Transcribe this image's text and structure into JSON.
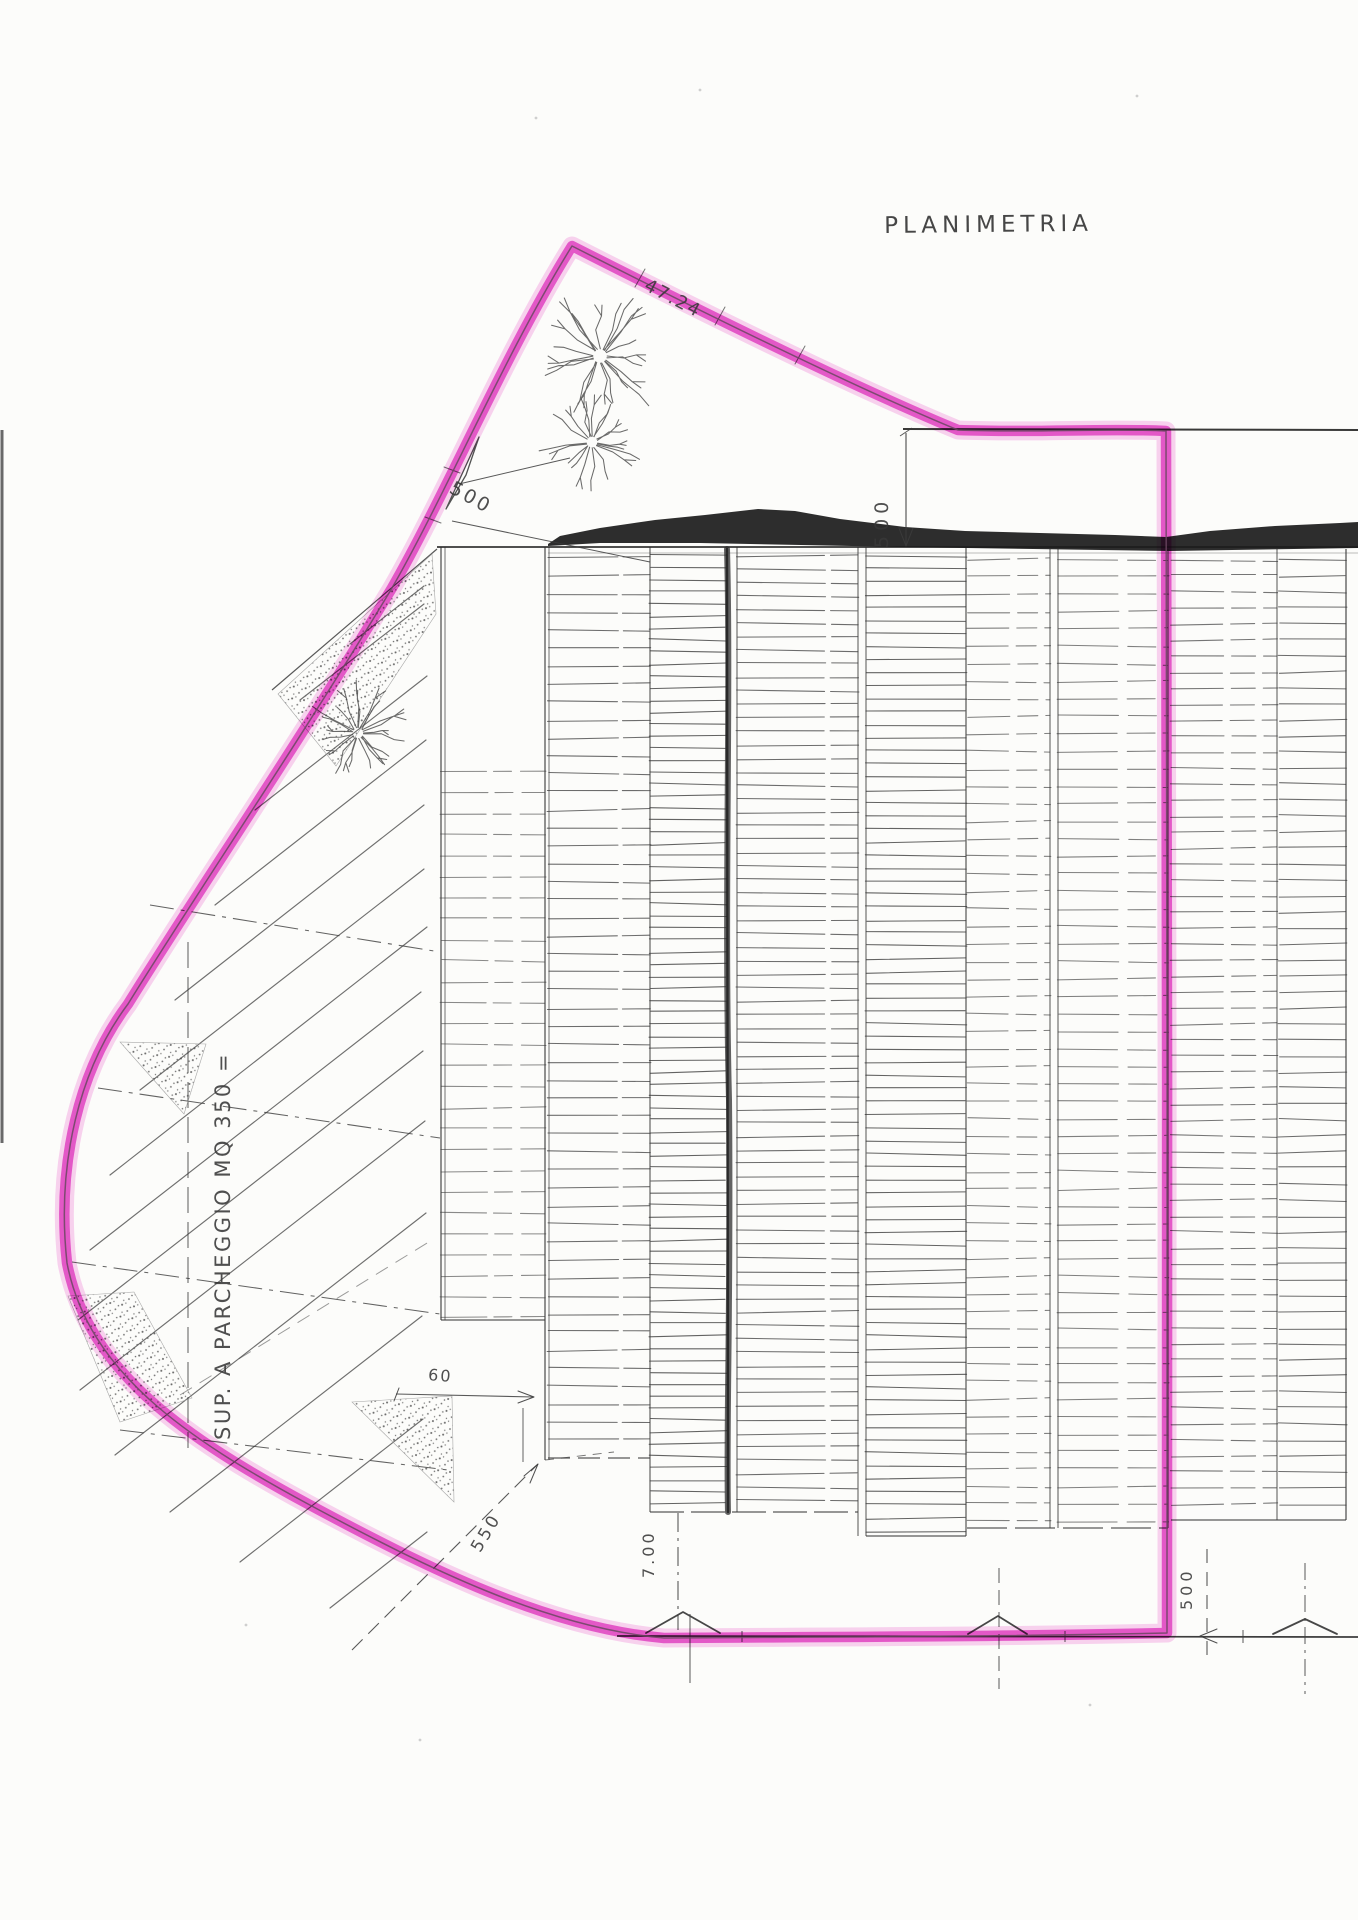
{
  "drawing": {
    "title": "PLANIMETRIA"
  },
  "parking": {
    "label": "SUP. A PARCHEGGIO MQ 350 ="
  },
  "dimensions": {
    "top_edge": "47.24",
    "upper_left_setback": "500",
    "roof_setback": "500",
    "building_gap": "60",
    "drive_width": "550",
    "entrance_width": "7.00",
    "street_setback": "500"
  },
  "colors": {
    "highlighter_core": "#e646cc",
    "highlighter_halo": "#f5a9e6",
    "boundary_ink": "#6b4660",
    "ink": "#3c3c3c",
    "roof_fill": "#1b1b1b",
    "paper": "#fcfcfa"
  }
}
